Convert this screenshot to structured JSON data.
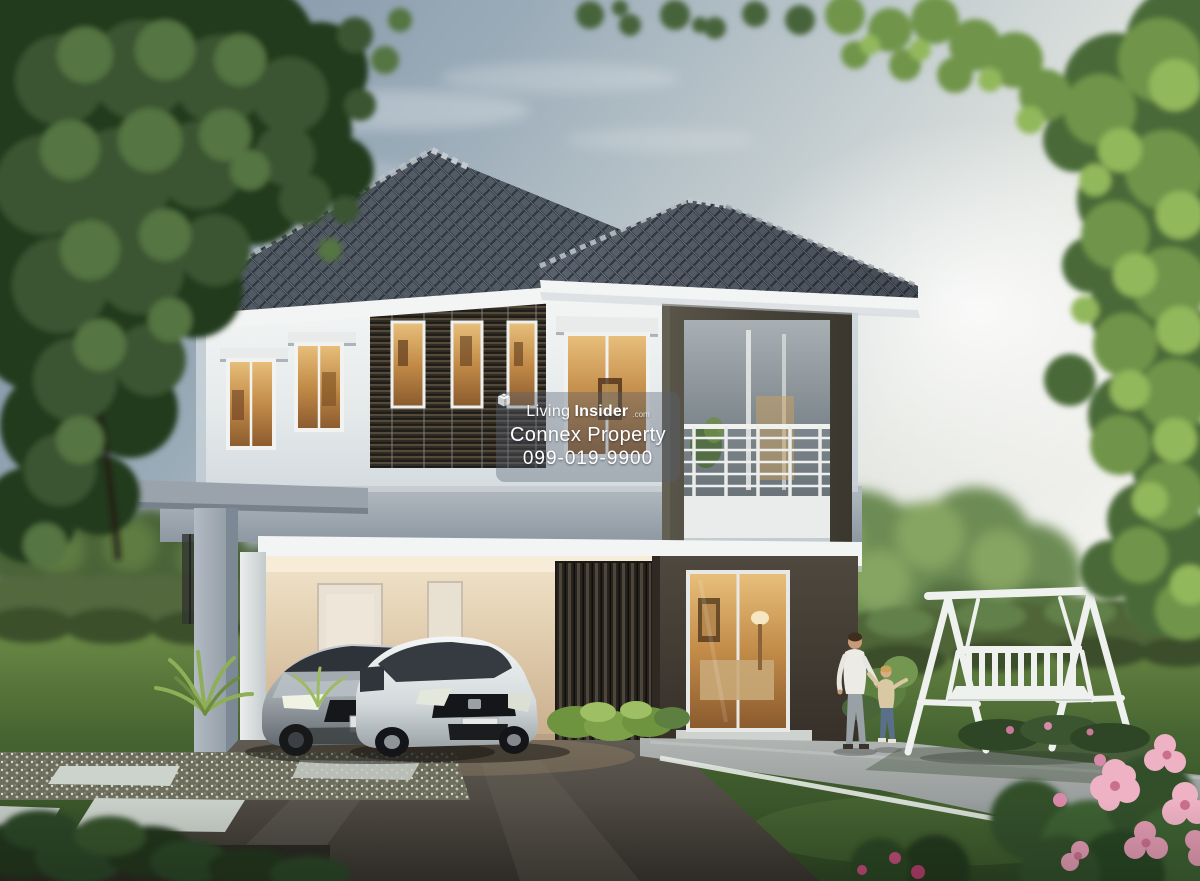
{
  "watermark": {
    "logo_icon": "living-insider-cube-logo",
    "brand_light": "Living",
    "brand_bold": "Insider",
    "brand_tld": ".com",
    "line2": "Connex Property",
    "line3": "099-019-9900"
  },
  "palette": {
    "sky_top": "#7b8fa2",
    "sky_bright": "#f1f1ed",
    "roof_tile": "#5a626d",
    "roof_line": "#323943",
    "wall_white": "#eef0f1",
    "wall_shade": "#cdd6dc",
    "accent_dark_frame": "#46423a",
    "louver_dark": "#2c2823",
    "window_glow": "#e8b05c",
    "slab_gray": "#9aa5ae",
    "fascia_white": "#f3f5f4",
    "carport_warm": "#e2cfae",
    "grass": "#55743a",
    "grass_dark": "#2f4824",
    "hedge": "#4d6238",
    "tree_left": "#3a5530",
    "tree_right": "#6f9449",
    "driveway": "#45423c",
    "walkway": "#9aa0a0",
    "swing_white": "#eef1ee",
    "flower_pink": "#e8a8bc",
    "car_sedan_silver": "#b4bbc0",
    "car_hatch_white": "#e9eceb"
  }
}
